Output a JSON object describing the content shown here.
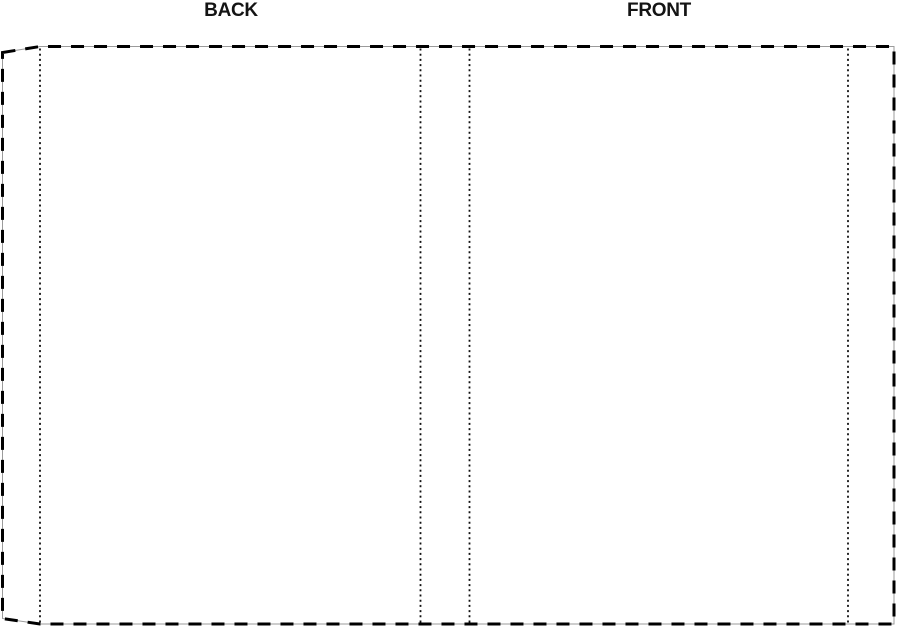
{
  "template": {
    "back_label": "BACK",
    "front_label": "FRONT"
  },
  "colors": {
    "background": "#ffffff",
    "label_text": "#141414",
    "boundary_dash": "#000000",
    "boundary_baseline": "#9b9b9b",
    "fold_dots": "#111111"
  }
}
